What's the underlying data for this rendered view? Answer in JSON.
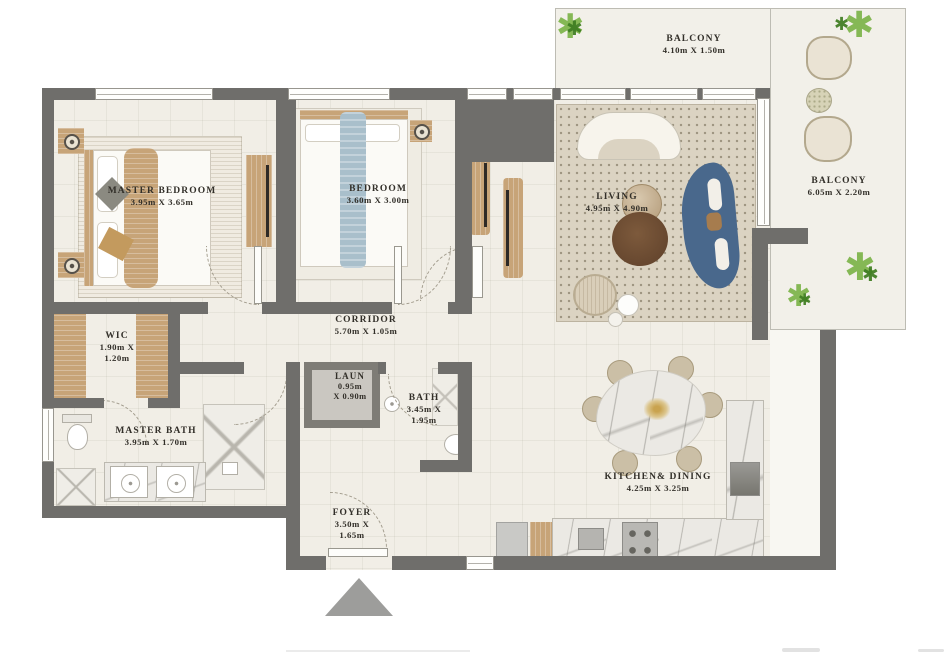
{
  "rooms": [
    {
      "id": "master-bedroom",
      "name": "MASTER BEDROOM",
      "dims": [
        "3.95m X 3.65m"
      ]
    },
    {
      "id": "bedroom",
      "name": "BEDROOM",
      "dims": [
        "3.60m X 3.00m"
      ]
    },
    {
      "id": "living",
      "name": "LIVING",
      "dims": [
        "4.95m X 4.90m"
      ]
    },
    {
      "id": "balcony-top",
      "name": "BALCONY",
      "dims": [
        "4.10m X 1.50m"
      ]
    },
    {
      "id": "balcony-right",
      "name": "BALCONY",
      "dims": [
        "6.05m X 2.20m"
      ]
    },
    {
      "id": "wic",
      "name": "WIC",
      "dims": [
        "1.90m X",
        "1.20m"
      ]
    },
    {
      "id": "corridor",
      "name": "CORRIDOR",
      "dims": [
        "5.70m X 1.05m"
      ]
    },
    {
      "id": "laundry",
      "name": "LAUN",
      "dims": [
        "0.95m",
        "X 0.90m"
      ]
    },
    {
      "id": "bath",
      "name": "BATH",
      "dims": [
        "3.45m X",
        "1.95m"
      ]
    },
    {
      "id": "master-bath",
      "name": "MASTER BATH",
      "dims": [
        "3.95m X 1.70m"
      ]
    },
    {
      "id": "foyer",
      "name": "FOYER",
      "dims": [
        "3.50m X",
        "1.65m"
      ]
    },
    {
      "id": "kitchen-dining",
      "name": "KITCHEN& DINING",
      "dims": [
        "4.25m X 3.25m"
      ]
    }
  ],
  "icons": {
    "plant_glyph": "✱"
  },
  "palette": {
    "wall": "#6f6e6b",
    "floor": "#f1eee6",
    "balcony": "#f2f0e9",
    "wood": "#c7a478",
    "sofa_blue": "#49688c",
    "plant_green": "#7ab246",
    "marble": "#ebe9e4",
    "entry_triangle": "#9d9d9b"
  }
}
